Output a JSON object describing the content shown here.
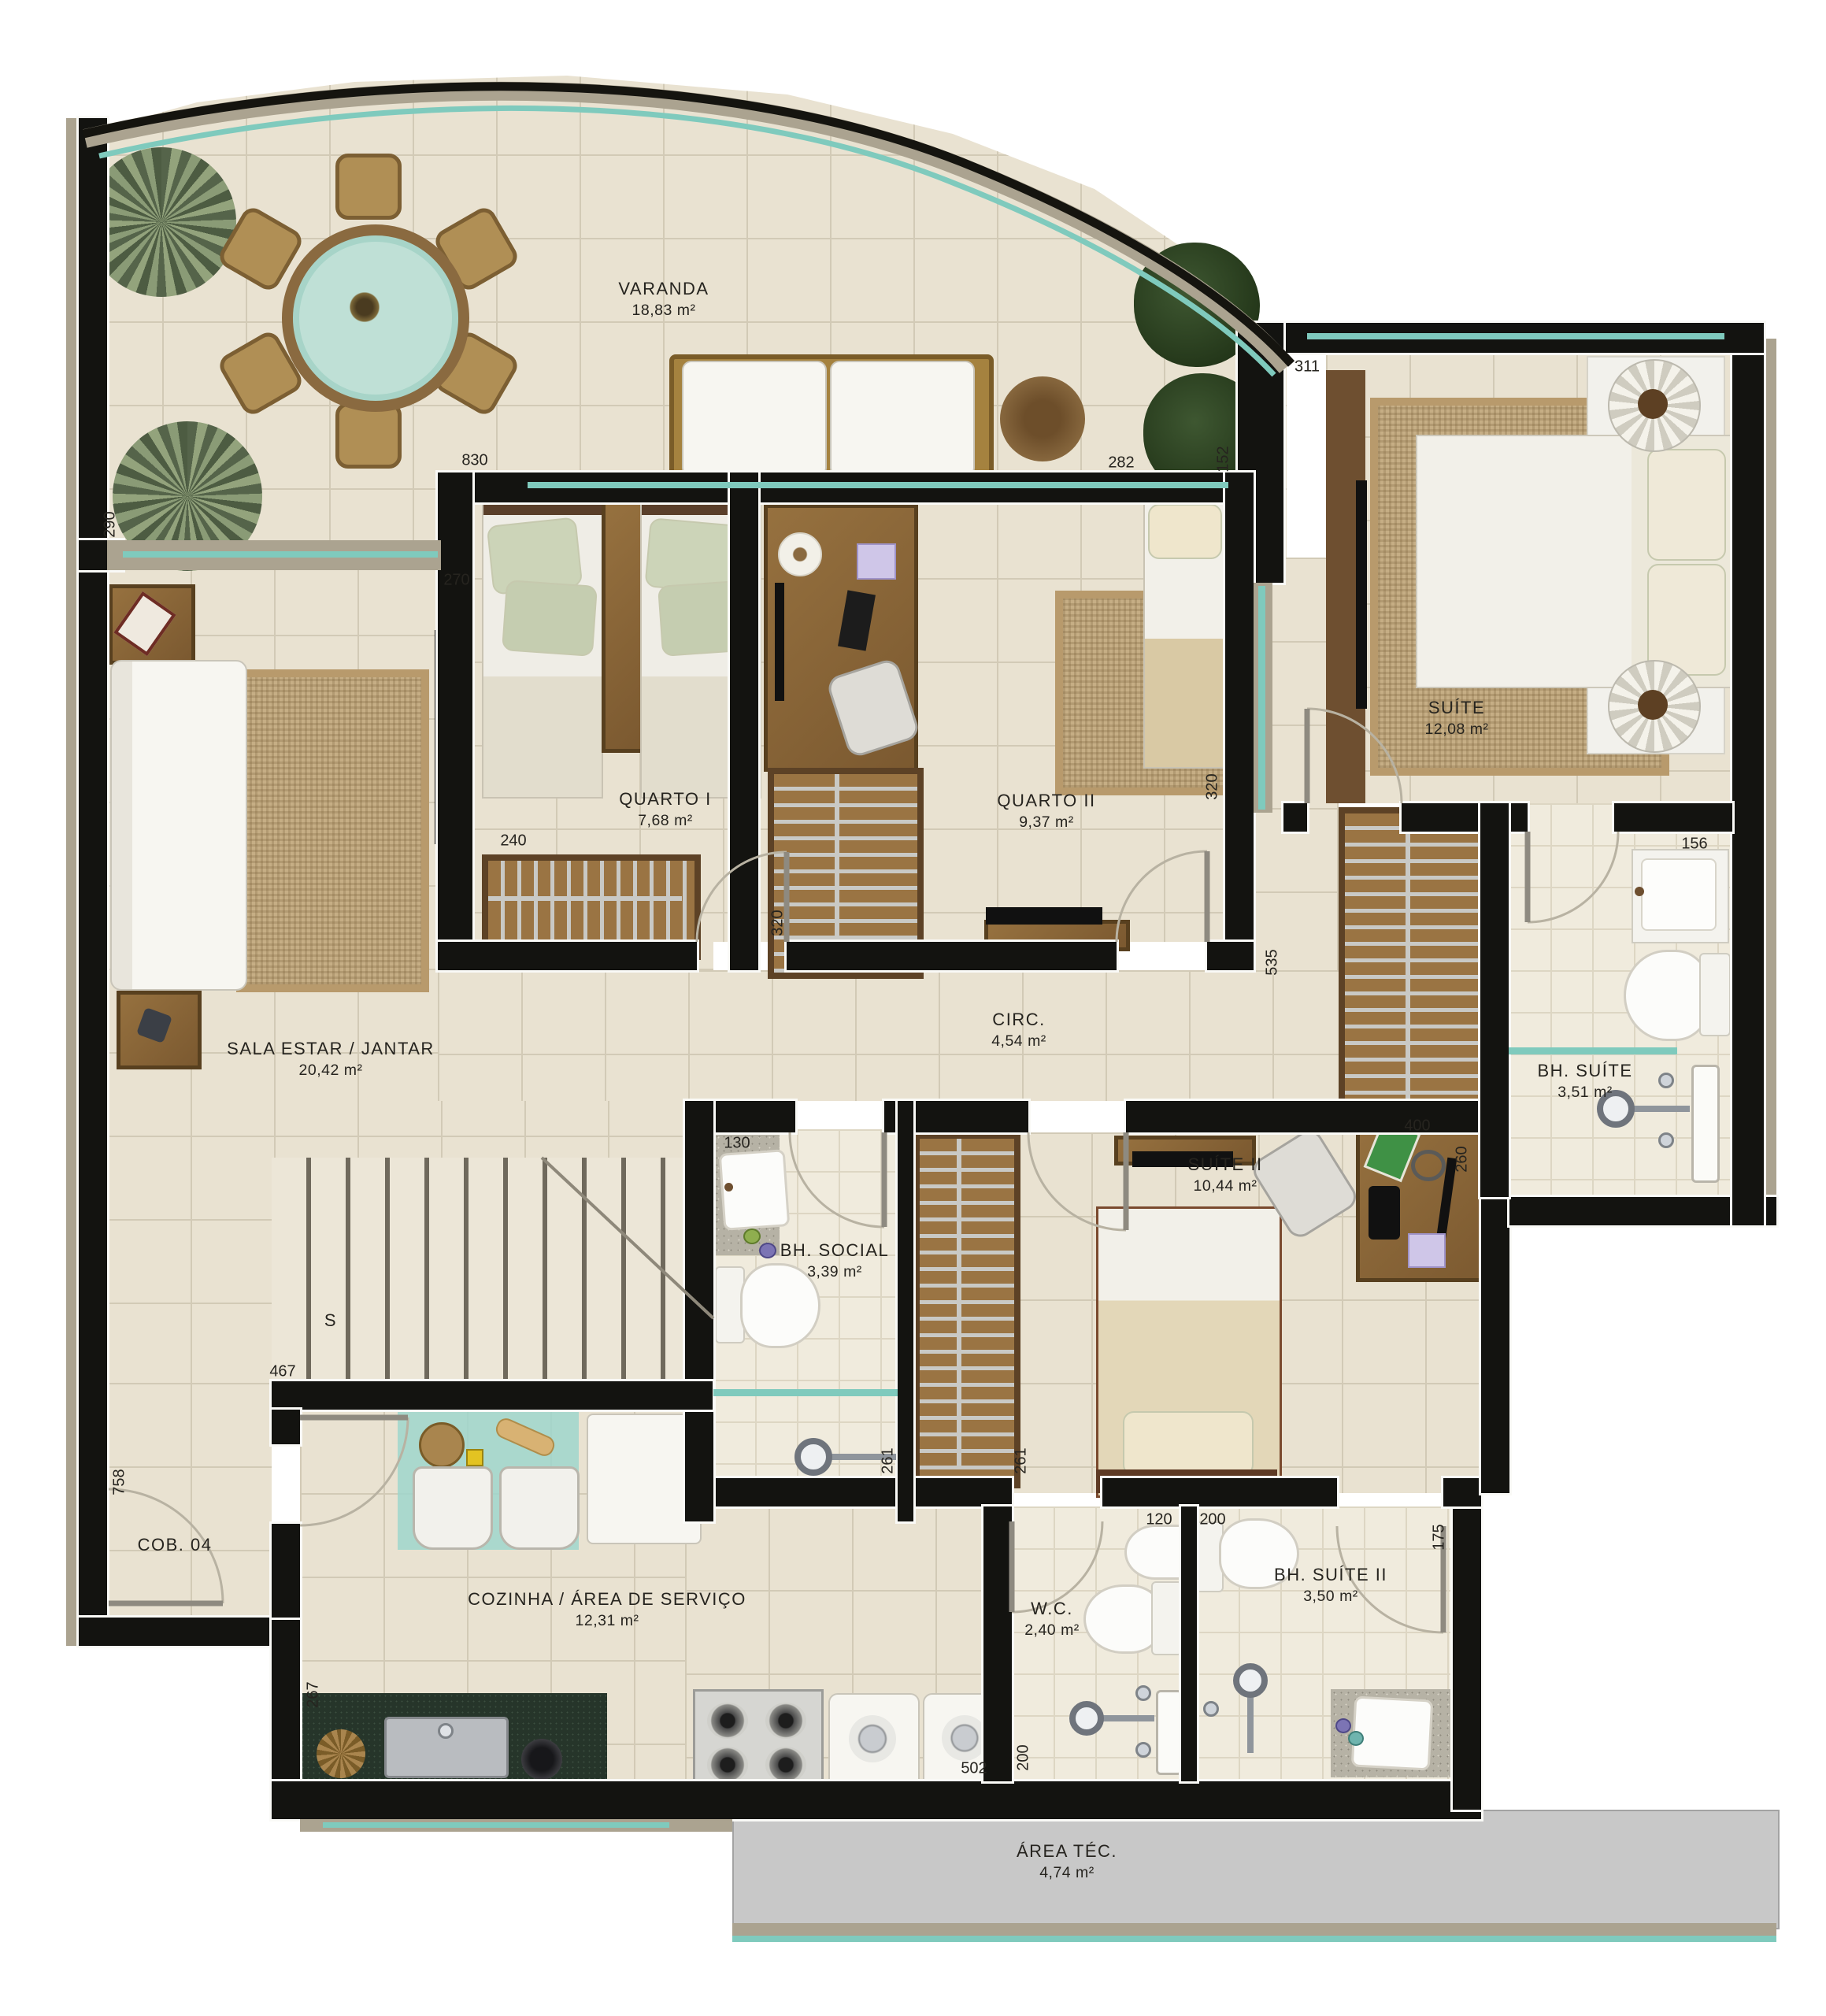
{
  "plan": {
    "unit": "COB. 04",
    "stairs": "S",
    "rooms": {
      "varanda": {
        "name": "VARANDA",
        "area": "18,83 m²"
      },
      "quarto1": {
        "name": "QUARTO I",
        "area": "7,68 m²"
      },
      "quarto2": {
        "name": "QUARTO II",
        "area": "9,37 m²"
      },
      "suite": {
        "name": "SUÍTE",
        "area": "12,08 m²"
      },
      "sala": {
        "name": "SALA ESTAR / JANTAR",
        "area": "20,42 m²"
      },
      "circ": {
        "name": "CIRC.",
        "area": "4,54 m²"
      },
      "bh_social": {
        "name": "BH. SOCIAL",
        "area": "3,39 m²"
      },
      "suite2": {
        "name": "SUÍTE II",
        "area": "10,44 m²"
      },
      "bh_suite": {
        "name": "BH. SUÍTE",
        "area": "3,51 m²"
      },
      "cozinha": {
        "name": "COZINHA / ÁREA DE SERVIÇO",
        "area": "12,31 m²"
      },
      "wc": {
        "name": "W.C.",
        "area": "2,40 m²"
      },
      "bh_suite2": {
        "name": "BH. SUÍTE II",
        "area": "3,50 m²"
      },
      "area_tec": {
        "name": "ÁREA TÉC.",
        "area": "4,74 m²"
      }
    },
    "dims": {
      "d290": "290",
      "d830": "830",
      "d270": "270",
      "d240": "240",
      "d320a": "320",
      "d282": "282",
      "d152": "152",
      "d311": "311",
      "d320b": "320",
      "d535": "535",
      "d156": "156",
      "d130": "130",
      "d400": "400",
      "d260": "260",
      "d261a": "261",
      "d261b": "261",
      "d467": "467",
      "d758": "758",
      "d267": "267",
      "d120": "120",
      "d200a": "200",
      "d175": "175",
      "d200b": "200",
      "d502": "502"
    },
    "colors": {
      "wall": "#131310",
      "floor": "#e9e2d1",
      "glass": "#7fcabd",
      "wood": "#8a6a40",
      "rug": "#c6ae85",
      "area_tec_fill": "#c8c8c8"
    }
  }
}
